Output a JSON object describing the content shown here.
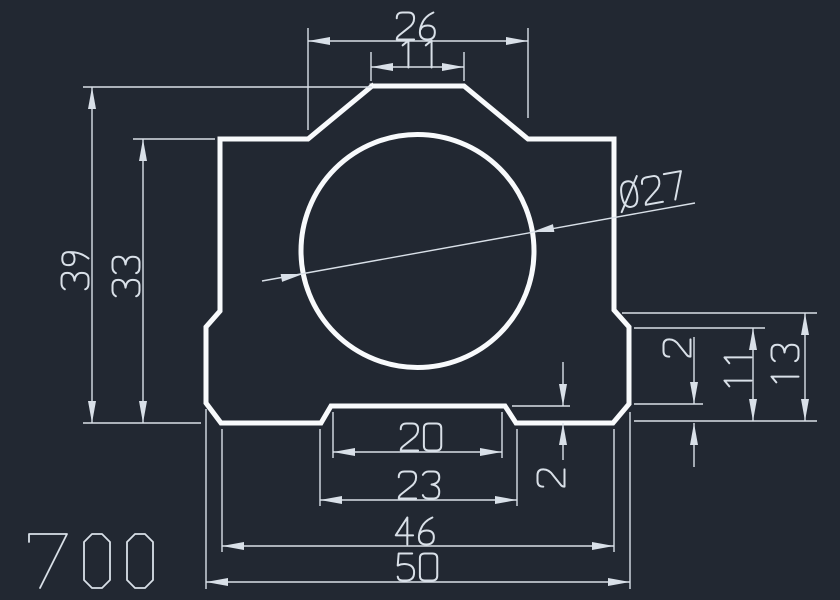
{
  "canvas": {
    "width": 840,
    "height": 600,
    "background_color": "#222832",
    "entity_color": "#f8fafc",
    "dimension_color": "#d9e0e8",
    "entity_stroke_width": 5,
    "dimension_stroke_width": 1.4
  },
  "title_block": {
    "drawing_number": "700"
  },
  "part": {
    "description": "pillow-block profile with central bore",
    "outline_points": [
      [
        372,
        86
      ],
      [
        464,
        86
      ],
      [
        528,
        139
      ],
      [
        614,
        139
      ],
      [
        614,
        310
      ],
      [
        629,
        327
      ],
      [
        629,
        404
      ],
      [
        613,
        423
      ],
      [
        516,
        423
      ],
      [
        505,
        406
      ],
      [
        331,
        406
      ],
      [
        321,
        423
      ],
      [
        221,
        423
      ],
      [
        206,
        403
      ],
      [
        206,
        327
      ],
      [
        220,
        311
      ],
      [
        220,
        139
      ],
      [
        308,
        139
      ],
      [
        372,
        86
      ]
    ],
    "bore_circle": {
      "cx": 417.5,
      "cy": 251,
      "r": 116.5
    }
  },
  "dimensions": [
    {
      "value": "26",
      "orientation": "horizontal",
      "text": {
        "x": 417,
        "y": 26,
        "rot": 0
      },
      "lines": [
        [
          308,
          41,
          528,
          41
        ],
        [
          308,
          28,
          308,
          130
        ],
        [
          528,
          28,
          528,
          118
        ]
      ],
      "arrows": [
        [
          308,
          41,
          0
        ],
        [
          528,
          41,
          180
        ]
      ]
    },
    {
      "value": "11",
      "orientation": "horizontal",
      "text": {
        "x": 420,
        "y": 54,
        "rot": 0
      },
      "lines": [
        [
          371,
          67,
          464,
          67
        ],
        [
          371,
          52,
          371,
          81
        ],
        [
          464,
          52,
          464,
          81
        ]
      ],
      "arrows": [
        [
          371,
          67,
          0
        ],
        [
          464,
          67,
          180
        ]
      ]
    },
    {
      "value": "39",
      "orientation": "vertical",
      "text": {
        "x": 75,
        "y": 270,
        "rot": -90
      },
      "lines": [
        [
          92,
          87,
          92,
          423
        ],
        [
          83,
          87,
          372,
          87
        ],
        [
          83,
          423,
          201,
          423
        ]
      ],
      "arrows": [
        [
          92,
          87,
          90
        ],
        [
          92,
          423,
          -90
        ]
      ]
    },
    {
      "value": "33",
      "orientation": "vertical",
      "text": {
        "x": 126,
        "y": 277,
        "rot": -90
      },
      "lines": [
        [
          143,
          139,
          143,
          423
        ],
        [
          133,
          139,
          215,
          139
        ]
      ],
      "arrows": [
        [
          143,
          139,
          90
        ],
        [
          143,
          423,
          -90
        ]
      ]
    },
    {
      "value": "Ø27",
      "orientation": "aligned-leader",
      "text": {
        "x": 652,
        "y": 190,
        "rot": -10.2
      },
      "lines": [
        [
          262,
          281,
          695,
          203
        ]
      ],
      "arrows": [
        [
          303,
          274,
          169.8
        ],
        [
          532,
          232,
          -10.2
        ]
      ]
    },
    {
      "value": "2",
      "orientation": "vertical",
      "text": {
        "x": 677,
        "y": 348,
        "rot": -90
      },
      "lines": [
        [
          694,
          337,
          694,
          404
        ],
        [
          694,
          423,
          694,
          467
        ],
        [
          634,
          404,
          703,
          404
        ]
      ],
      "arrows": [
        [
          694,
          404,
          -90
        ],
        [
          694,
          423,
          90
        ]
      ]
    },
    {
      "value": "11",
      "orientation": "vertical",
      "text": {
        "x": 738,
        "y": 369,
        "rot": -90
      },
      "lines": [
        [
          753,
          328,
          753,
          421
        ],
        [
          634,
          328,
          765,
          328
        ]
      ],
      "arrows": [
        [
          753,
          328,
          90
        ],
        [
          753,
          421,
          -90
        ]
      ]
    },
    {
      "value": "13",
      "orientation": "vertical",
      "text": {
        "x": 785,
        "y": 365,
        "rot": -90
      },
      "lines": [
        [
          805,
          313,
          805,
          421
        ],
        [
          622,
          313,
          817,
          313
        ],
        [
          634,
          421,
          817,
          421
        ]
      ],
      "arrows": [
        [
          805,
          313,
          90
        ],
        [
          805,
          421,
          -90
        ]
      ]
    },
    {
      "value": "20",
      "orientation": "horizontal",
      "text": {
        "x": 421,
        "y": 437,
        "rot": 0
      },
      "lines": [
        [
          333,
          452,
          502,
          452
        ],
        [
          333,
          412,
          333,
          458
        ],
        [
          502,
          412,
          502,
          458
        ]
      ],
      "arrows": [
        [
          333,
          452,
          0
        ],
        [
          502,
          452,
          180
        ]
      ]
    },
    {
      "value": "2",
      "orientation": "vertical",
      "text": {
        "x": 551,
        "y": 478,
        "rot": -90
      },
      "lines": [
        [
          563,
          362,
          563,
          406
        ],
        [
          563,
          423,
          563,
          460
        ],
        [
          512,
          406,
          570,
          406
        ]
      ],
      "arrows": [
        [
          563,
          406,
          -90
        ],
        [
          563,
          423,
          90
        ]
      ]
    },
    {
      "value": "23",
      "orientation": "horizontal",
      "text": {
        "x": 419,
        "y": 485,
        "rot": 0
      },
      "lines": [
        [
          320,
          500,
          517,
          500
        ],
        [
          320,
          429,
          320,
          506
        ],
        [
          517,
          429,
          517,
          506
        ]
      ],
      "arrows": [
        [
          320,
          500,
          0
        ],
        [
          517,
          500,
          180
        ]
      ]
    },
    {
      "value": "46",
      "orientation": "horizontal",
      "text": {
        "x": 416,
        "y": 531,
        "rot": 0
      },
      "lines": [
        [
          222,
          546,
          614,
          546
        ],
        [
          222,
          429,
          222,
          552
        ],
        [
          614,
          429,
          614,
          552
        ]
      ],
      "arrows": [
        [
          222,
          546,
          0
        ],
        [
          614,
          546,
          180
        ]
      ]
    },
    {
      "value": "50",
      "orientation": "horizontal",
      "text": {
        "x": 417,
        "y": 567,
        "rot": 0
      },
      "lines": [
        [
          206,
          582,
          630,
          582
        ],
        [
          206,
          409,
          206,
          589
        ],
        [
          630,
          412,
          630,
          589
        ]
      ],
      "arrows": [
        [
          206,
          582,
          0
        ],
        [
          630,
          582,
          180
        ]
      ]
    }
  ]
}
